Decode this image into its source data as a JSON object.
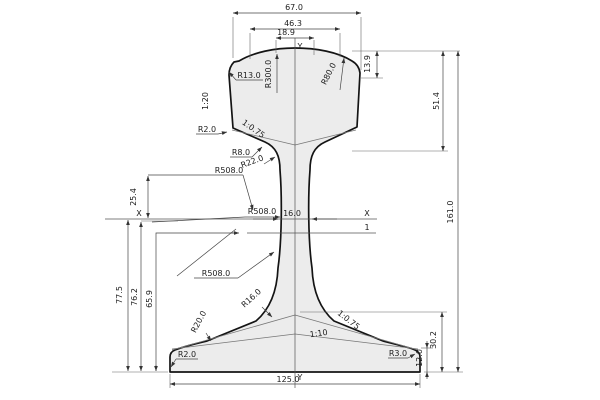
{
  "drawing": {
    "title": "rail cross-section technical drawing",
    "colors": {
      "background": "#ffffff",
      "profile_fill": "#ececec",
      "outline": "#141414",
      "dimension_lines": "#444444"
    },
    "axes": {
      "x_left": "X",
      "x_right": "X",
      "y_top": "Y",
      "y_bottom": "Y",
      "section_mark": "1"
    },
    "dims": {
      "head_width": "67.0",
      "head_mid_width": "46.3",
      "crown_flat_width": "18.9",
      "gauge_corner_drop": "13.9",
      "head_height": "51.4",
      "total_height": "161.0",
      "web_thickness": "16.0",
      "axis_offset": "25.4",
      "foot_to_axis_a": "77.5",
      "foot_to_axis_b": "76.2",
      "foot_to_section": "65.9",
      "foot_height": "30.2",
      "foot_edge_height": "12.0",
      "foot_width": "125.0"
    },
    "radii": {
      "head_corner": "R13.0",
      "crown": "R300.0",
      "head_side": "R80.0",
      "head_lower_corner": "R2.0",
      "head_web_fillet_small": "R8.0",
      "head_web_fillet_large": "R22.0",
      "web_upper": "R508.0",
      "web_mid": "R508.0",
      "web_lower": "R508.0",
      "web_foot_fillet": "R16.0",
      "foot_top_fillet": "R20.0",
      "foot_edge_left": "R2.0",
      "foot_edge_right": "R3.0"
    },
    "slopes": {
      "head_side": "1:20",
      "head_underside": "1:0.75",
      "foot_transition": "1:0.75",
      "foot_top": "1:10"
    }
  }
}
